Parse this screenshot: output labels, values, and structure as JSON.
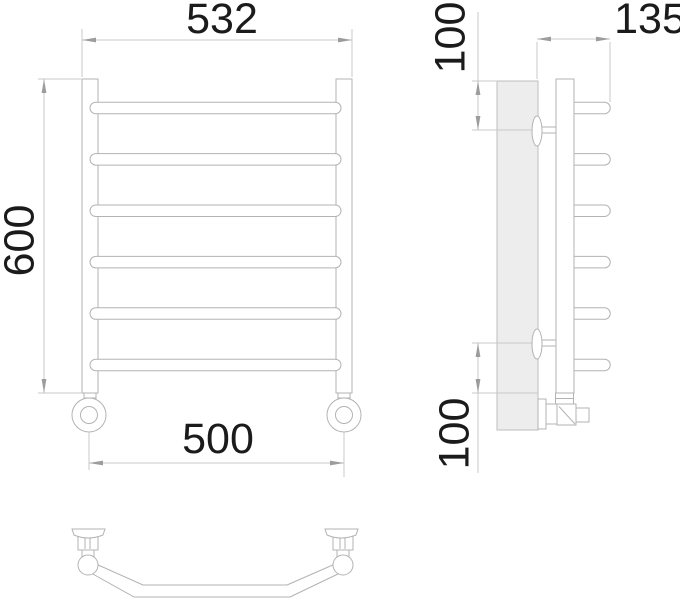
{
  "drawing": {
    "dimensions": {
      "overall_width": "532",
      "overall_height": "600",
      "mounting_centers": "500",
      "top_bracket_offset": "100",
      "wall_clearance": "135",
      "bottom_bracket_offset": "100"
    },
    "structure": {
      "rung_count": 6,
      "views": [
        "front",
        "side",
        "bottom"
      ]
    },
    "colors": {
      "object_line": "#b3b3b3",
      "dimension_line": "#c9c9c9",
      "arrow": "#9c9c9c",
      "text": "#1b1b1b",
      "wall_fill": "#ededed",
      "background": "#ffffff"
    }
  }
}
